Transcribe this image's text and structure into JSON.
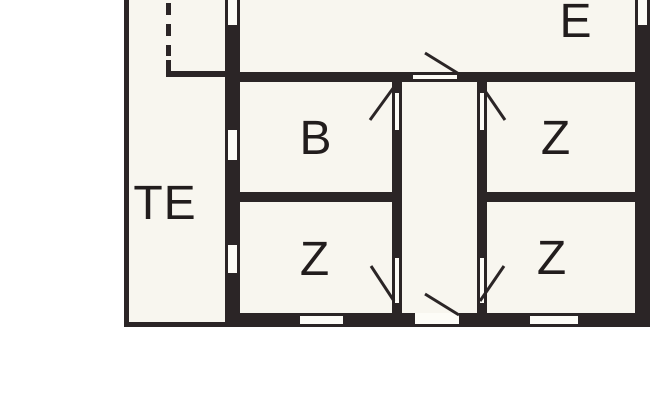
{
  "floorplan": {
    "rooms": [
      {
        "label": "TE"
      },
      {
        "label": "E"
      },
      {
        "label": "B"
      },
      {
        "label": "Z"
      },
      {
        "label": "Z"
      },
      {
        "label": "Z"
      }
    ],
    "colors": {
      "wall": "#2b2526",
      "floor": "#f8f6ef",
      "opening": "#fdfcf7",
      "background": "#ffffff",
      "text": "#221d1d"
    }
  }
}
